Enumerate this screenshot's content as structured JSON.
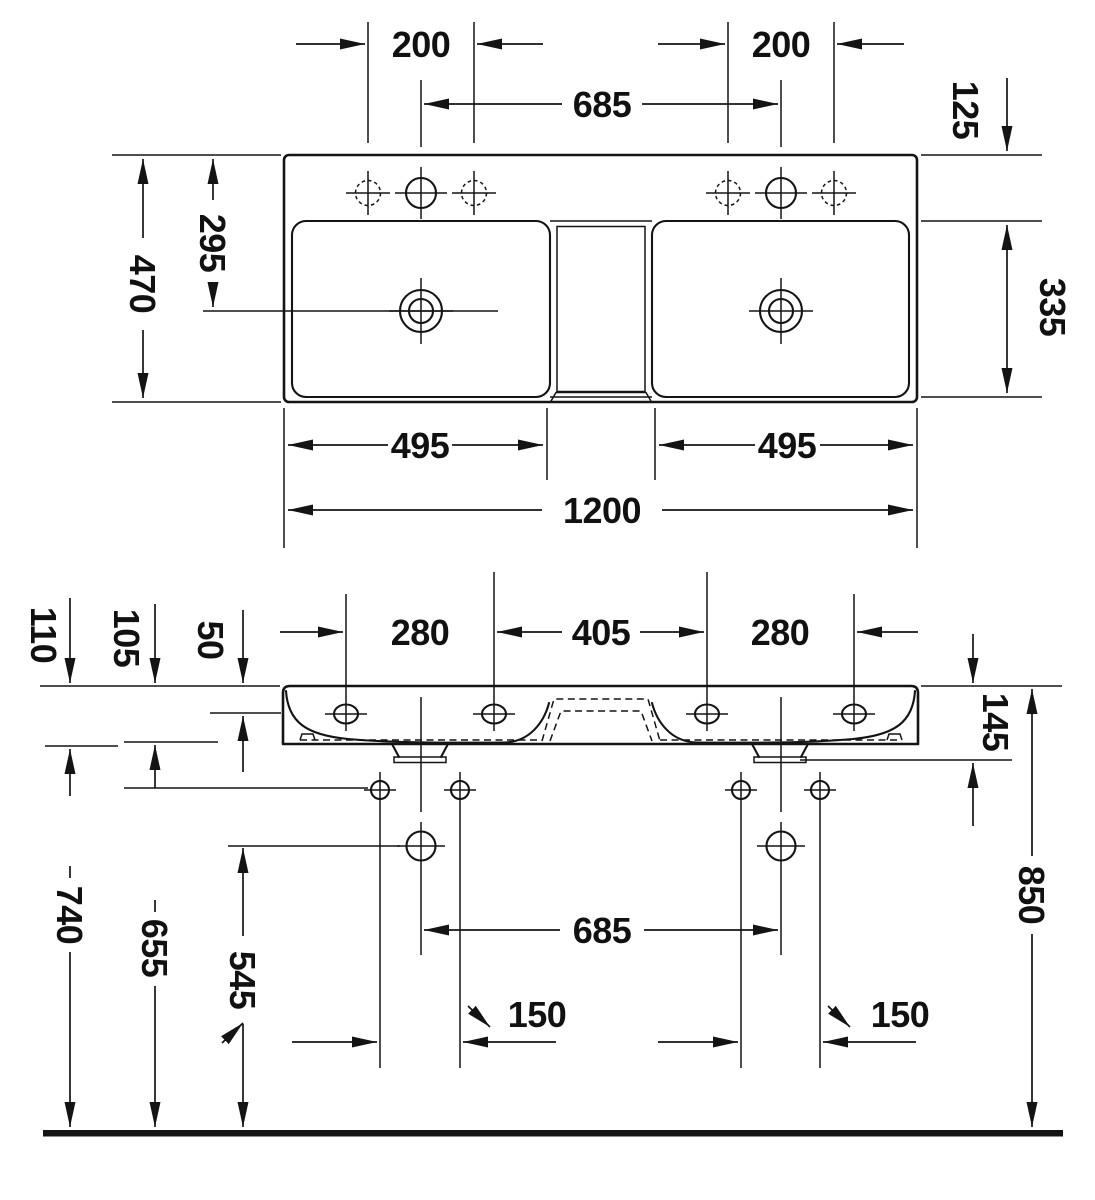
{
  "meta": {
    "description": "Technical dimension drawing of a 1200 mm double washbasin (plan view and front elevation)",
    "ink_color": "#141414",
    "background_color": "#ffffff",
    "unit": "mm"
  },
  "plan": {
    "tap_hole_pitch_left": "200",
    "tap_hole_pitch_right": "200",
    "tap_centres": "685",
    "rear_to_basin_edge": "125",
    "rear_to_drain": "295",
    "total_depth": "470",
    "basin_inner_depth": "335",
    "basin_width_left": "495",
    "basin_width_right": "495",
    "total_width": "1200"
  },
  "front": {
    "body_height_total": "110",
    "body_height_inner": "105",
    "rim_to_ledge": "50",
    "face_holes_left": "280",
    "face_holes_mid": "405",
    "face_holes_right": "280",
    "rim_to_outlet": "145",
    "supply_centres": "685",
    "fixing_pitch_left": "150",
    "fixing_pitch_right": "150",
    "floor_to_underside": "740",
    "floor_to_fixing": "655",
    "floor_to_supply": "545",
    "floor_to_rim": "850"
  }
}
